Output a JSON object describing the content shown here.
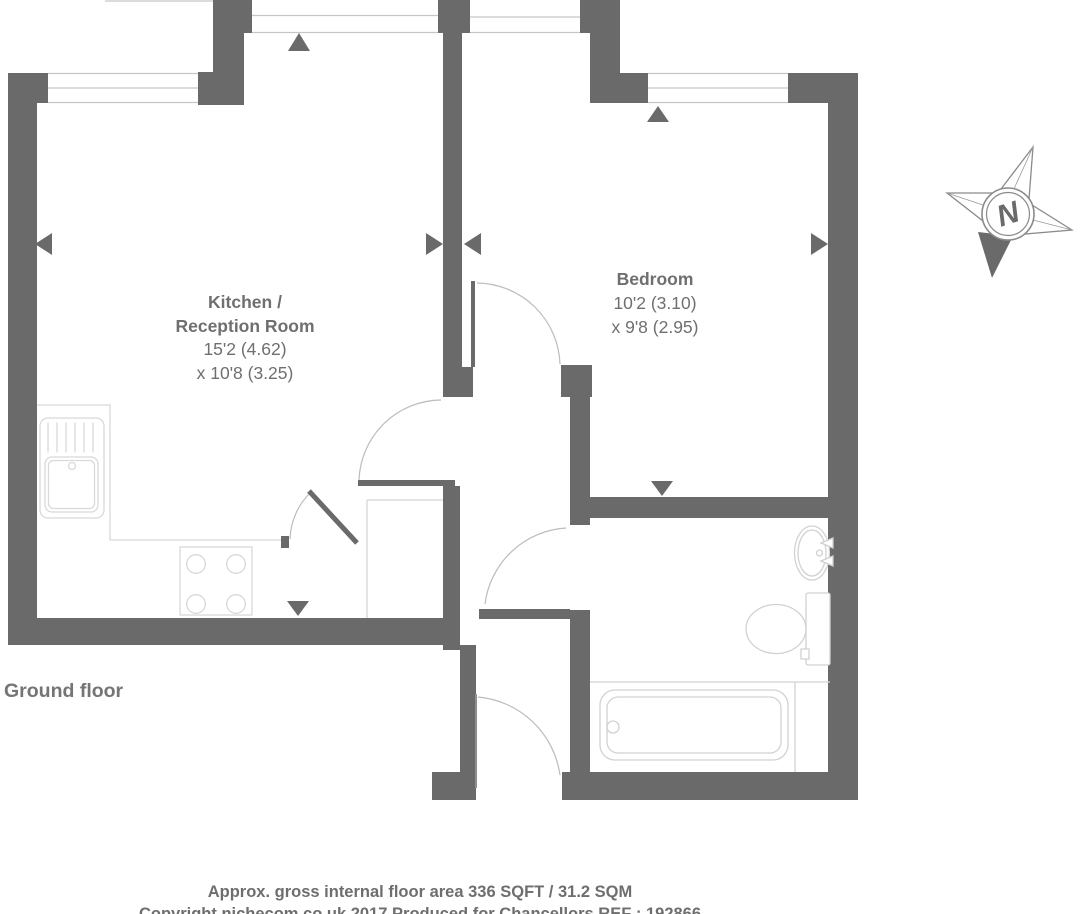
{
  "floorplan": {
    "floor_label": "Ground floor",
    "kitchen": {
      "name_line1": "Kitchen /",
      "name_line2": "Reception Room",
      "dim_line1": "15'2 (4.62)",
      "dim_line2": "x 10'8 (3.25)"
    },
    "bedroom": {
      "name": "Bedroom",
      "dim_line1": "10'2 (3.10)",
      "dim_line2": "x 9'8 (2.95)"
    },
    "compass": {
      "north_label": "N"
    },
    "footer": {
      "area_note": "Approx. gross internal floor area 336 SQFT / 31.2 SQM",
      "copyright_note": "Copyright nichecom.co.uk 2017 Produced for Chancellors REF : 192866"
    },
    "colors": {
      "wall_gray": "#6a6a6a",
      "window_line": "#c6c6c6",
      "fixture_line": "#d7d9da",
      "text_gray": "#6f6f6f"
    }
  }
}
